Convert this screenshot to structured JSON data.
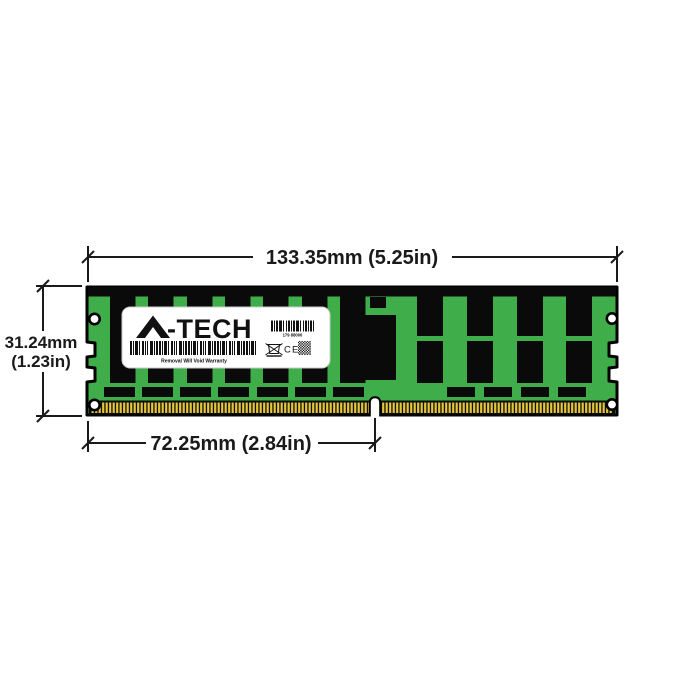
{
  "figure": {
    "background_color": "#ffffff",
    "type": "memory-module-dimension-diagram"
  },
  "module": {
    "pcb_color": "#3fae4a",
    "chip_color": "#0a0a0a",
    "pin_gold_color": "#e2c43e",
    "outline_color": "#000000"
  },
  "label": {
    "brand": "A-TECH",
    "brand_suffix": "-TECH",
    "serial": "179 88000",
    "warranty": "Removal Will Void Warranty",
    "ce_mark": "CE"
  },
  "dimensions": {
    "width_label": "133.35mm (5.25in)",
    "height_label_line1": "31.24mm",
    "height_label_line2": "(1.23in)",
    "pin_label": "72.25mm (2.84in)",
    "line_color": "#1a1a1a"
  }
}
